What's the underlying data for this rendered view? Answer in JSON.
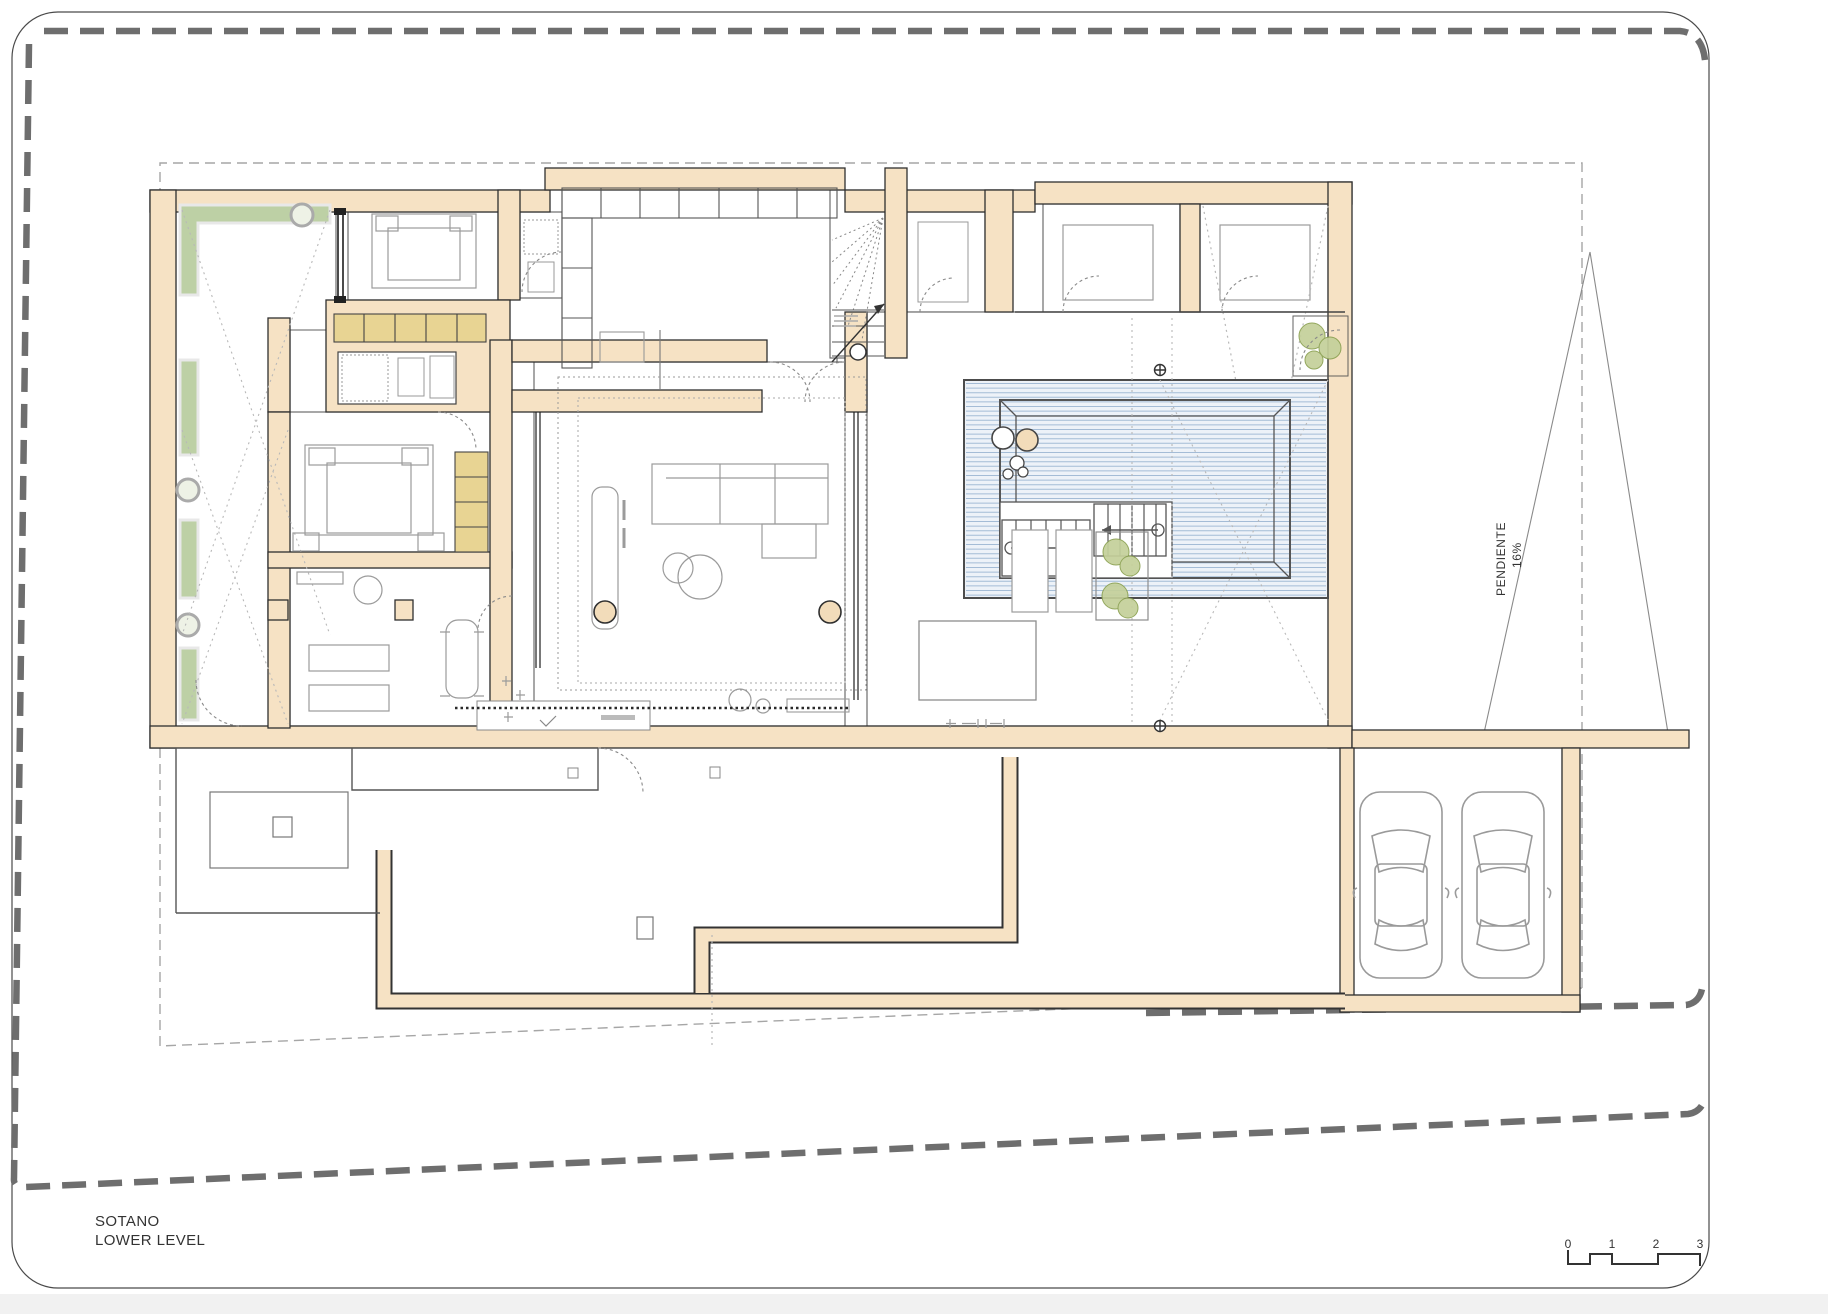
{
  "drawing": {
    "title_primary": "SOTANO",
    "title_secondary": "LOWER LEVEL",
    "slope_label": "PENDIENTE",
    "slope_value": "16%",
    "scale_ticks": [
      "0",
      "1",
      "2",
      "3"
    ]
  },
  "colors": {
    "wall": "#f6e2c4",
    "wall_outline": "#2f2f2f",
    "room_outline": "#5f5f5f",
    "closet": "#e8d493",
    "planter": "#bdd0a5",
    "plant_stroke": "#8aa050",
    "plant_fill": "#c4d09a",
    "pool_fill": "#edf2f8",
    "pool_stripe": "#a4bcd6",
    "pool_edge": "#4c4c4c",
    "furniture": "#9b9b9b",
    "boundary": "#6e6e6e",
    "setback": "#a6a6a6",
    "light_dash": "#b8b8b8",
    "door_arc": "#8a8a8a",
    "glass": "#1e1e1e",
    "column": "#f2dcba",
    "text": "#333333",
    "page_border": "#4a4a4a",
    "outside": "#f1f1f1",
    "car": "#9a9a9a"
  }
}
